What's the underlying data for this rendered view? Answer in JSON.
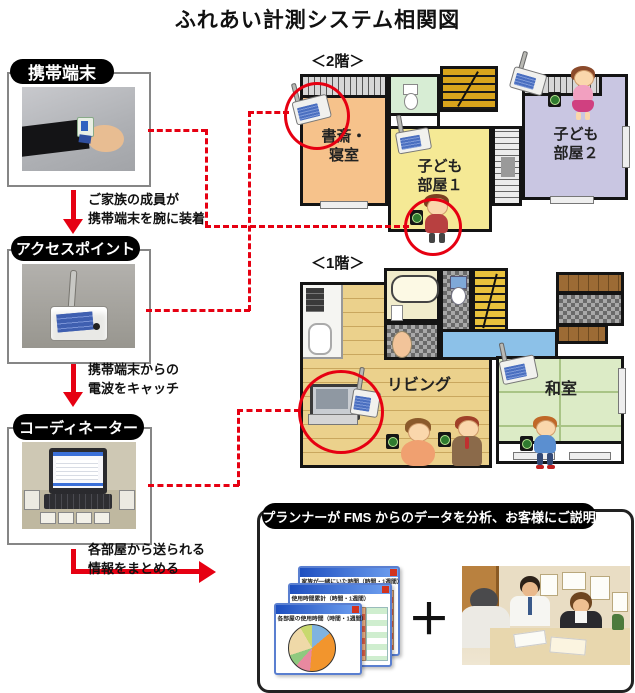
{
  "title": "ふれあい計測システム相関図",
  "colors": {
    "accent_red": "#e60012",
    "label_bg": "#000000",
    "room_study": "#f6c28b",
    "room_kids1": "#f5e995",
    "room_kids2": "#c9c6e2",
    "room_living": "#ebd18c",
    "room_washitsu": "#dcebc6",
    "hallway_blue": "#8cc1e8"
  },
  "left_column": [
    {
      "label": "携帯端末",
      "caption_line1": "ご家族の成員が",
      "caption_line2": "携帯端末を腕に装着",
      "photo": "wrist-worn mobile terminal on arm"
    },
    {
      "label": "アクセスポイント",
      "caption_line1": "携帯端末からの",
      "caption_line2": "電波をキャッチ",
      "photo": "access point box with antenna"
    },
    {
      "label": "コーディネーター",
      "caption_line1": "各部屋から送られる",
      "caption_line2": "情報をまとめる",
      "photo": "laptop coordinator with receiver units"
    }
  ],
  "floor2": {
    "label": "＜2階＞",
    "rooms": [
      {
        "line1": "書斎・",
        "line2": "寝室"
      },
      {
        "line1": "子ども",
        "line2": "部屋１"
      },
      {
        "line1": "子ども",
        "line2": "部屋２"
      }
    ]
  },
  "floor1": {
    "label": "＜1階＞",
    "rooms": [
      {
        "name": "リビング"
      },
      {
        "name": "和室"
      }
    ]
  },
  "bottom_panel": {
    "label": "プランナーが FMS からのデータを分析、お客様にご説明",
    "plus": "＋",
    "windows": [
      {
        "title": "家族が一緒にいた時間（時間・1週間）"
      },
      {
        "title": "使用時間累計（時間・1週間）"
      },
      {
        "title": "各部屋の使用時間（時間・1週間）"
      }
    ]
  }
}
